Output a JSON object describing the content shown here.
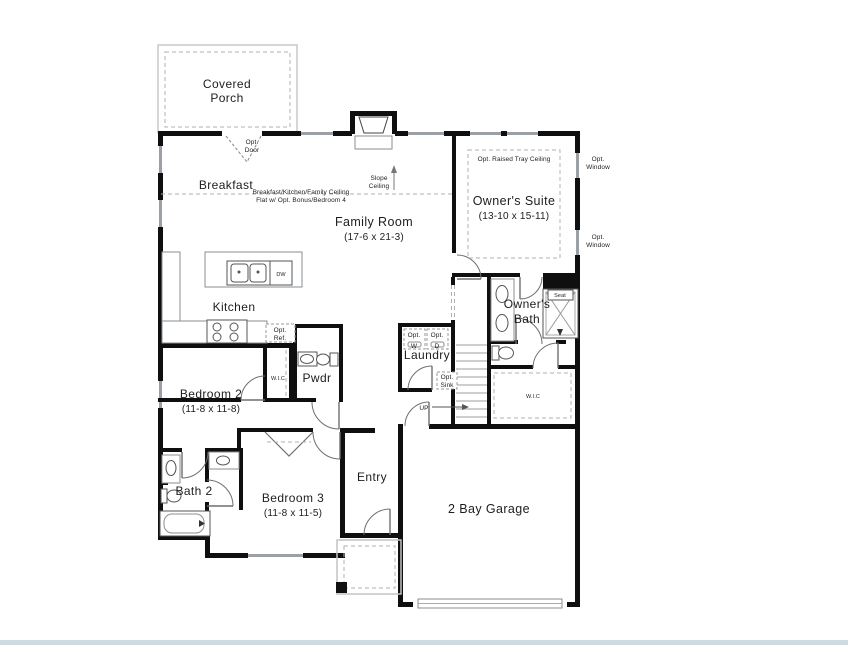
{
  "plan": {
    "rooms": {
      "covered_porch_line1": "Covered",
      "covered_porch_line2": "Porch",
      "breakfast": "Breakfast",
      "family_room": "Family Room",
      "family_room_dims": "(17-6 x 21-3)",
      "owners_suite": "Owner's Suite",
      "owners_suite_dims": "(13-10 x 15-11)",
      "kitchen": "Kitchen",
      "bedroom2": "Bedroom 2",
      "bedroom2_dims": "(11-8 x 11-8)",
      "bedroom3": "Bedroom 3",
      "bedroom3_dims": "(11-8 x 11-5)",
      "bath2": "Bath 2",
      "owners_bath_line1": "Owner's",
      "owners_bath_line2": "Bath",
      "pwdr": "Pwdr",
      "laundry": "Laundry",
      "entry": "Entry",
      "garage": "2 Bay Garage",
      "wic_bedroom2": "W.I.C",
      "wic_owners": "W.I.C"
    },
    "notes": {
      "ceiling_note1": "Breakfast/Kitchen/Family Ceiling",
      "ceiling_note2": "Flat w/ Opt. Bonus/Bedroom 4",
      "slope1": "Slope",
      "slope2": "Ceiling",
      "tray": "Opt. Raised Tray Ceiling",
      "opt_door1": "Opt.",
      "opt_door2": "Door",
      "opt_window1": "Opt.",
      "opt_window2": "Window",
      "opt_ref1": "Opt.",
      "opt_ref2": "Ref.",
      "opt_w1": "Opt.",
      "opt_w2": "W",
      "opt_d1": "Opt.",
      "opt_d2": "D",
      "opt_sink1": "Opt.",
      "opt_sink2": "Sink",
      "dw": "DW",
      "up": "UP",
      "seat": "Seat"
    },
    "colors": {
      "wall": "#0f0f0f",
      "window": "#9aa0a6",
      "page_strip": "#ccdce1",
      "text": "#1d1d1d"
    }
  }
}
